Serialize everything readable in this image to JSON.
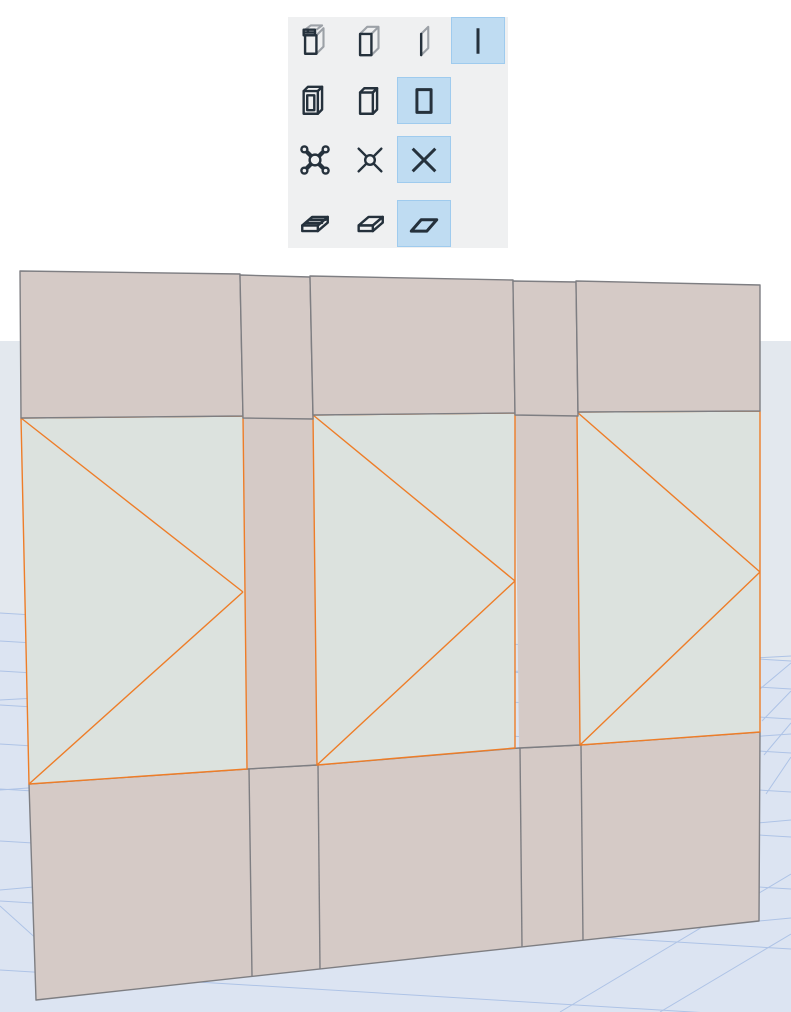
{
  "palette": {
    "rows": [
      {
        "name": "wall-display",
        "options": [
          {
            "icon": "wall-composite",
            "selected": false
          },
          {
            "icon": "wall-block",
            "selected": false
          },
          {
            "icon": "wall-plane",
            "selected": false
          },
          {
            "icon": "wall-line",
            "selected": true
          }
        ]
      },
      {
        "name": "opening-display",
        "options": [
          {
            "icon": "opening-frame",
            "selected": false
          },
          {
            "icon": "opening-block",
            "selected": false
          },
          {
            "icon": "opening-symbol",
            "selected": true
          }
        ]
      },
      {
        "name": "object-display",
        "options": [
          {
            "icon": "object-detailed",
            "selected": false
          },
          {
            "icon": "object-simple",
            "selected": false
          },
          {
            "icon": "object-x",
            "selected": true
          }
        ]
      },
      {
        "name": "slab-display",
        "options": [
          {
            "icon": "slab-composite",
            "selected": false
          },
          {
            "icon": "slab-block",
            "selected": false
          },
          {
            "icon": "slab-plane",
            "selected": true
          }
        ]
      }
    ],
    "colors": {
      "palette_bg": "#eff0f1",
      "selected_fill": "#bfdcf2",
      "selected_border": "#9fcbee",
      "icon_dark": "#25313c",
      "icon_gray": "#9ca1a7"
    }
  },
  "viewport": {
    "colors": {
      "sky": "#ffffff",
      "ground": "#e3e8ee",
      "mesh": "#dce4f2",
      "grid_line": "#aec3e6",
      "wall_fill": "#d5cac6",
      "panel_fill": "#dce2de",
      "outline": "#7e7e82",
      "highlight": "#ee7d28"
    }
  }
}
